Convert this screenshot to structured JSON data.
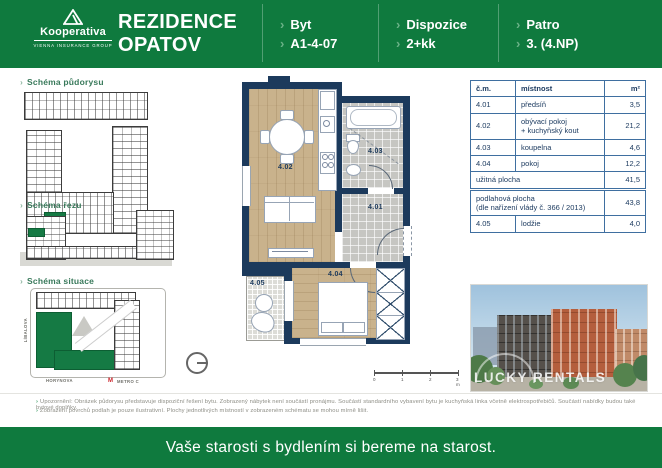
{
  "glyphs": {
    "chevron": "›",
    "metro_m": "M"
  },
  "colors": {
    "brand_green": "#0f7a3e",
    "chevron_green": "#6ab287",
    "navy": "#1c3a5c",
    "wood": "#c9b28c",
    "tile_gray": "#c6c6c2",
    "table_border": "#3f6fa0",
    "metro_red": "#cc2229"
  },
  "header": {
    "logo": {
      "brand": "Kooperativa",
      "subbrand": "VIENNA INSURANCE GROUP"
    },
    "title_line1": "REZIDENCE",
    "title_line2": "OPATOV",
    "sections": [
      {
        "label": "Byt",
        "value": "A1-4-07"
      },
      {
        "label": "Dispozice",
        "value": "2+kk"
      },
      {
        "label": "Patro",
        "value": "3. (4.NP)"
      }
    ]
  },
  "sidebar": {
    "schematics": [
      {
        "label": "Schéma půdorysu"
      },
      {
        "label": "Schéma řezu"
      },
      {
        "label": "Schéma situace"
      }
    ],
    "situace": {
      "street_left": "LÍBALOVA",
      "street_bottom": "HORYNOVA",
      "metro": "METRO C"
    }
  },
  "floorplan": {
    "rooms": [
      {
        "id": "4.01"
      },
      {
        "id": "4.02"
      },
      {
        "id": "4.03"
      },
      {
        "id": "4.04"
      },
      {
        "id": "4.05"
      }
    ],
    "scalebar": {
      "ticks": [
        "0",
        "1",
        "2",
        "3 m"
      ]
    }
  },
  "table": {
    "headers": [
      "č.m.",
      "místnost",
      "m²"
    ],
    "rows": [
      {
        "num": "4.01",
        "name": "předsíň",
        "area": "3,5"
      },
      {
        "num": "4.02",
        "name_line1": "obývací pokoj",
        "name_line2": "+ kuchyňský kout",
        "area": "21,2"
      },
      {
        "num": "4.03",
        "name": "koupelna",
        "area": "4,6"
      },
      {
        "num": "4.04",
        "name": "pokoj",
        "area": "12,2"
      }
    ],
    "summary_uzitna": {
      "name": "užitná plocha",
      "area": "41,5"
    },
    "summary_podlahova": {
      "name_line1": "podlahová plocha",
      "name_line2": "(dle nařízení vlády č. 366 / 2013)",
      "area": "43,8"
    },
    "extra_row": {
      "num": "4.05",
      "name": "lodžie",
      "area": "4,0"
    }
  },
  "photo": {
    "watermark": "LUCKY RENTALS"
  },
  "disclaimer": {
    "line1": "Upozornění: Obrázek půdorysu představuje dispoziční řešení bytu. Zobrazený nábytek není součástí pronájmu. Součástí standardního vybavení bytu je kuchyňská linka včetně elektrospotřebičů. Součástí nabídky budou také bytové doplňky.",
    "line2": "Zobrazení povrchů podlah je pouze ilustrativní. Plochy jednotlivých místností v zobrazeném schématu se mohou mírně lišit."
  },
  "footer": {
    "slogan": "Vaše starosti s bydlením si bereme na starost."
  }
}
